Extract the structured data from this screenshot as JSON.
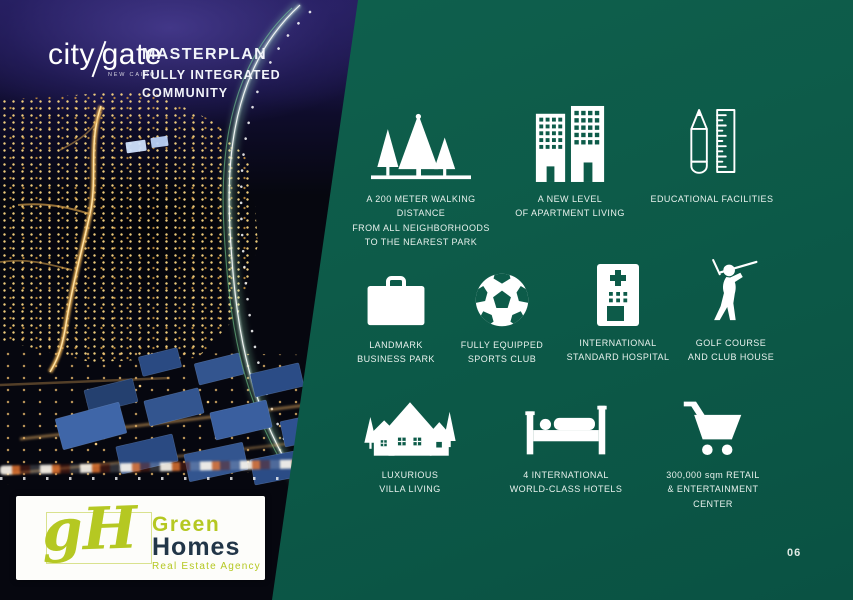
{
  "colors": {
    "panel_green": "#0d5b49",
    "night_base": "#06070f",
    "sky_indigo": "#2e2670",
    "street_gold": "#e2a94f",
    "building_blue": "#33558f",
    "agency_lime": "#b5c822",
    "agency_navy": "#223648",
    "text_white": "#e8f1ed"
  },
  "header": {
    "brand": {
      "part1": "city",
      "part2": "gate",
      "subtext": "NEW CAIRO"
    },
    "titles": [
      "MASTERPLAN",
      "FULLY INTEGRATED",
      "COMMUNITY"
    ]
  },
  "features": {
    "items": [
      {
        "icon": "trees-icon",
        "label": "A 200 METER WALKING DISTANCE\nFROM  ALL NEIGHBORHOODS\nTO THE NEAREST PARK"
      },
      {
        "icon": "apartments-icon",
        "label": "A NEW LEVEL\nOF APARTMENT LIVING"
      },
      {
        "icon": "pencil-ruler-icon",
        "label": "EDUCATIONAL FACILITIES"
      },
      {
        "icon": "briefcase-icon",
        "label": "LANDMARK\nBUSINESS PARK"
      },
      {
        "icon": "soccer-ball-icon",
        "label": "FULLY EQUIPPED\nSPORTS CLUB"
      },
      {
        "icon": "hospital-icon",
        "label": "INTERNATIONAL\nSTANDARD HOSPITAL"
      },
      {
        "icon": "golfer-icon",
        "label": "GOLF COURSE\nAND CLUB HOUSE"
      },
      {
        "icon": "villas-icon",
        "label": "LUXURIOUS\nVILLA LIVING"
      },
      {
        "icon": "bed-icon",
        "label": "4 INTERNATIONAL\nWORLD-CLASS HOTELS"
      },
      {
        "icon": "cart-icon",
        "label": "300,000 sqm RETAIL\n& ENTERTAINMENT\nCENTER"
      }
    ]
  },
  "footer": {
    "page_number": "06",
    "agency": {
      "monogram": "gH",
      "line1": "Green",
      "line2": "Homes",
      "tagline": "Real Estate Agency"
    }
  }
}
